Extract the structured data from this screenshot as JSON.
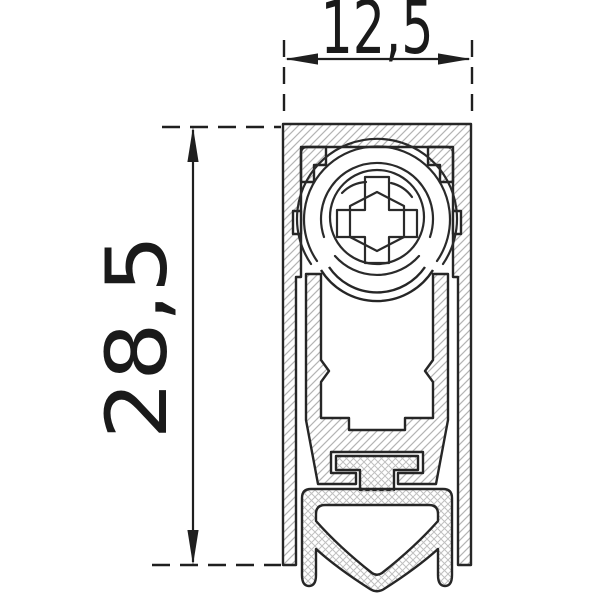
{
  "diagram": {
    "type": "technical-cross-section",
    "subject": "automatic drop-down door bottom seal profile",
    "dimension_labels": {
      "width": "12,5",
      "height": "28,5"
    },
    "style": {
      "line_color": "#262626",
      "dimension_line_color": "#1f1f1f",
      "dimension_text_color": "#1a1a1a",
      "hatch_color": "#b4b4b4",
      "crosshatch_color": "#c0c0c0",
      "background": "#ffffff"
    }
  }
}
